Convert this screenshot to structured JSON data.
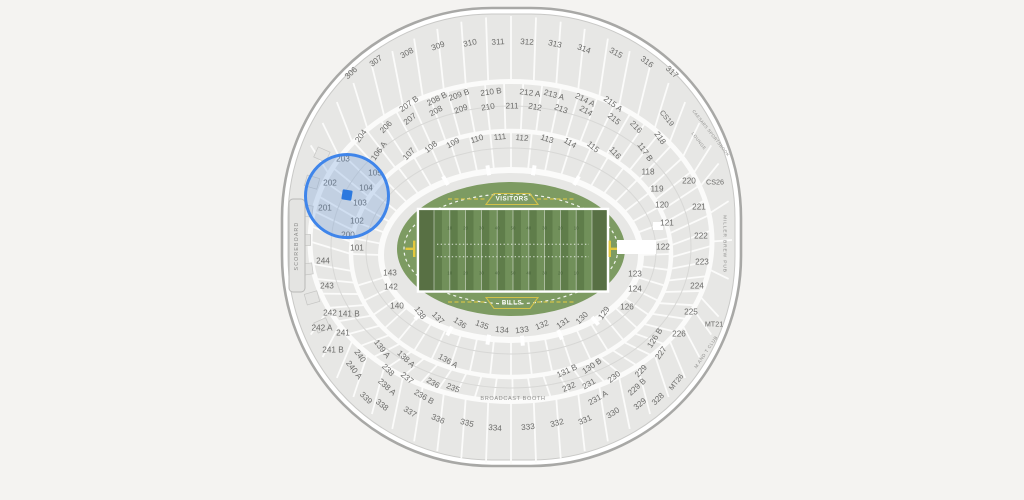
{
  "canvas": {
    "width": 1024,
    "height": 500,
    "background": "#f4f3f1"
  },
  "stadium": {
    "bowl_fill": "#e7e7e5",
    "bowl_edge": "#a8a8a6",
    "aisle_color": "#fbfbfa",
    "section_fill": "#e4e4e2",
    "section_edge": "#c6c6c4",
    "label_color": "#6b6b69"
  },
  "field": {
    "visitor_label": "VISITORS",
    "home_label": "BILLS",
    "yard_numbers": [
      "10",
      "20",
      "30",
      "40",
      "50",
      "40",
      "30",
      "20",
      "10"
    ],
    "turf": "#7d9b62",
    "stripe_dark": "#5f7d4a",
    "stripe_light": "#71905a",
    "endzone": "#587044",
    "goalpost": "#e2c83e",
    "accent_yellow": "#d3c24a"
  },
  "labels": {
    "scoreboard": "SCOREBOARD",
    "broadcast_booth": "BROADCAST BOOTH",
    "miller_brew_pub": "MILLER BREW PUB",
    "caesars_sportsbook": "CAESARS SPORTSBOOK",
    "lounge": "LOUNGE",
    "m_and_t_club": "M AND T CLUB"
  },
  "selection": {
    "highlight_color": "#3f85ea",
    "marker_color": "#2c79df",
    "circle": {
      "cx": 347,
      "cy": 196,
      "r": 43
    },
    "marker": {
      "cx": 347,
      "cy": 195
    },
    "highlighted_sections": [
      "201",
      "202",
      "203",
      "102",
      "103",
      "104",
      "105"
    ]
  },
  "sections": [
    {
      "l": "306",
      "x": 351,
      "y": 73
    },
    {
      "l": "307",
      "x": 376,
      "y": 61
    },
    {
      "l": "308",
      "x": 407,
      "y": 53
    },
    {
      "l": "309",
      "x": 438,
      "y": 46
    },
    {
      "l": "310",
      "x": 470,
      "y": 43
    },
    {
      "l": "311",
      "x": 498,
      "y": 42
    },
    {
      "l": "312",
      "x": 527,
      "y": 42
    },
    {
      "l": "313",
      "x": 555,
      "y": 44
    },
    {
      "l": "314",
      "x": 584,
      "y": 49
    },
    {
      "l": "315",
      "x": 616,
      "y": 53
    },
    {
      "l": "316",
      "x": 647,
      "y": 62
    },
    {
      "l": "317",
      "x": 672,
      "y": 72
    },
    {
      "l": "207 B",
      "x": 409,
      "y": 104
    },
    {
      "l": "208 B",
      "x": 437,
      "y": 99
    },
    {
      "l": "209 B",
      "x": 459,
      "y": 95
    },
    {
      "l": "210 B",
      "x": 491,
      "y": 92
    },
    {
      "l": "212 A",
      "x": 530,
      "y": 93
    },
    {
      "l": "213 A",
      "x": 554,
      "y": 95
    },
    {
      "l": "214 A",
      "x": 585,
      "y": 100
    },
    {
      "l": "215 A",
      "x": 613,
      "y": 104
    },
    {
      "l": "204",
      "x": 361,
      "y": 136
    },
    {
      "l": "206",
      "x": 386,
      "y": 127
    },
    {
      "l": "207",
      "x": 410,
      "y": 119
    },
    {
      "l": "208",
      "x": 436,
      "y": 111
    },
    {
      "l": "209",
      "x": 461,
      "y": 109
    },
    {
      "l": "210",
      "x": 488,
      "y": 107
    },
    {
      "l": "211",
      "x": 512,
      "y": 106
    },
    {
      "l": "212",
      "x": 535,
      "y": 107
    },
    {
      "l": "213",
      "x": 561,
      "y": 109
    },
    {
      "l": "214",
      "x": 586,
      "y": 111
    },
    {
      "l": "215",
      "x": 614,
      "y": 119
    },
    {
      "l": "216",
      "x": 636,
      "y": 127
    },
    {
      "l": "218",
      "x": 660,
      "y": 138
    },
    {
      "l": "CS19",
      "x": 667,
      "y": 118
    },
    {
      "l": "CS26",
      "x": 715,
      "y": 182
    },
    {
      "l": "MT21",
      "x": 714,
      "y": 324
    },
    {
      "l": "MT26",
      "x": 676,
      "y": 382
    },
    {
      "l": "106 A",
      "x": 379,
      "y": 151
    },
    {
      "l": "107",
      "x": 409,
      "y": 154
    },
    {
      "l": "108",
      "x": 431,
      "y": 147
    },
    {
      "l": "109",
      "x": 453,
      "y": 143
    },
    {
      "l": "110",
      "x": 477,
      "y": 139
    },
    {
      "l": "111",
      "x": 500,
      "y": 137
    },
    {
      "l": "112",
      "x": 522,
      "y": 138
    },
    {
      "l": "113",
      "x": 547,
      "y": 139
    },
    {
      "l": "114",
      "x": 570,
      "y": 143
    },
    {
      "l": "115",
      "x": 593,
      "y": 147
    },
    {
      "l": "116",
      "x": 615,
      "y": 153
    },
    {
      "l": "117 B",
      "x": 645,
      "y": 152
    },
    {
      "l": "118",
      "x": 648,
      "y": 172
    },
    {
      "l": "119",
      "x": 657,
      "y": 189
    },
    {
      "l": "120",
      "x": 662,
      "y": 205
    },
    {
      "l": "121",
      "x": 667,
      "y": 223
    },
    {
      "l": "122",
      "x": 663,
      "y": 247
    },
    {
      "l": "123",
      "x": 635,
      "y": 274
    },
    {
      "l": "124",
      "x": 635,
      "y": 289
    },
    {
      "l": "126",
      "x": 627,
      "y": 307
    },
    {
      "l": "220",
      "x": 689,
      "y": 181
    },
    {
      "l": "221",
      "x": 699,
      "y": 207
    },
    {
      "l": "222",
      "x": 701,
      "y": 236
    },
    {
      "l": "223",
      "x": 702,
      "y": 262
    },
    {
      "l": "224",
      "x": 697,
      "y": 286
    },
    {
      "l": "225",
      "x": 691,
      "y": 312
    },
    {
      "l": "226",
      "x": 679,
      "y": 334
    },
    {
      "l": "227",
      "x": 661,
      "y": 353
    },
    {
      "l": "229",
      "x": 641,
      "y": 371
    },
    {
      "l": "229 B",
      "x": 637,
      "y": 387
    },
    {
      "l": "230",
      "x": 614,
      "y": 377
    },
    {
      "l": "231",
      "x": 589,
      "y": 384
    },
    {
      "l": "231 A",
      "x": 598,
      "y": 398
    },
    {
      "l": "232",
      "x": 569,
      "y": 387
    },
    {
      "l": "203",
      "x": 343,
      "y": 159
    },
    {
      "l": "202",
      "x": 330,
      "y": 183
    },
    {
      "l": "201",
      "x": 325,
      "y": 208
    },
    {
      "l": "105",
      "x": 375,
      "y": 173
    },
    {
      "l": "104",
      "x": 366,
      "y": 188
    },
    {
      "l": "103",
      "x": 360,
      "y": 203
    },
    {
      "l": "102",
      "x": 357,
      "y": 221
    },
    {
      "l": "200",
      "x": 348,
      "y": 235
    },
    {
      "l": "101",
      "x": 357,
      "y": 248
    },
    {
      "l": "244",
      "x": 323,
      "y": 261
    },
    {
      "l": "243",
      "x": 327,
      "y": 286
    },
    {
      "l": "143",
      "x": 390,
      "y": 273
    },
    {
      "l": "142",
      "x": 391,
      "y": 287
    },
    {
      "l": "140",
      "x": 397,
      "y": 306
    },
    {
      "l": "141 B",
      "x": 349,
      "y": 314
    },
    {
      "l": "138",
      "x": 420,
      "y": 313
    },
    {
      "l": "137",
      "x": 438,
      "y": 318
    },
    {
      "l": "136",
      "x": 460,
      "y": 323
    },
    {
      "l": "135",
      "x": 482,
      "y": 325
    },
    {
      "l": "134",
      "x": 502,
      "y": 330
    },
    {
      "l": "133",
      "x": 522,
      "y": 330
    },
    {
      "l": "132",
      "x": 542,
      "y": 325
    },
    {
      "l": "131",
      "x": 563,
      "y": 323
    },
    {
      "l": "130",
      "x": 582,
      "y": 318
    },
    {
      "l": "129",
      "x": 604,
      "y": 313
    },
    {
      "l": "139 A",
      "x": 382,
      "y": 349
    },
    {
      "l": "138 A",
      "x": 406,
      "y": 359
    },
    {
      "l": "136 A",
      "x": 448,
      "y": 361
    },
    {
      "l": "131 B",
      "x": 567,
      "y": 371
    },
    {
      "l": "130 B",
      "x": 592,
      "y": 366
    },
    {
      "l": "126 B",
      "x": 655,
      "y": 338
    },
    {
      "l": "242",
      "x": 330,
      "y": 313
    },
    {
      "l": "242 A",
      "x": 322,
      "y": 328
    },
    {
      "l": "241",
      "x": 343,
      "y": 333
    },
    {
      "l": "241 B",
      "x": 333,
      "y": 350
    },
    {
      "l": "240",
      "x": 360,
      "y": 356
    },
    {
      "l": "240 A",
      "x": 354,
      "y": 370
    },
    {
      "l": "238",
      "x": 388,
      "y": 370
    },
    {
      "l": "237",
      "x": 407,
      "y": 378
    },
    {
      "l": "238 A",
      "x": 387,
      "y": 387
    },
    {
      "l": "236",
      "x": 433,
      "y": 383
    },
    {
      "l": "235",
      "x": 453,
      "y": 388
    },
    {
      "l": "236 B",
      "x": 424,
      "y": 397
    },
    {
      "l": "339",
      "x": 366,
      "y": 398
    },
    {
      "l": "338",
      "x": 382,
      "y": 405
    },
    {
      "l": "337",
      "x": 410,
      "y": 412
    },
    {
      "l": "336",
      "x": 438,
      "y": 419
    },
    {
      "l": "335",
      "x": 467,
      "y": 423
    },
    {
      "l": "334",
      "x": 495,
      "y": 428
    },
    {
      "l": "333",
      "x": 528,
      "y": 427
    },
    {
      "l": "332",
      "x": 557,
      "y": 423
    },
    {
      "l": "331",
      "x": 585,
      "y": 420
    },
    {
      "l": "330",
      "x": 613,
      "y": 413
    },
    {
      "l": "329",
      "x": 640,
      "y": 404
    },
    {
      "l": "328",
      "x": 658,
      "y": 399
    }
  ]
}
